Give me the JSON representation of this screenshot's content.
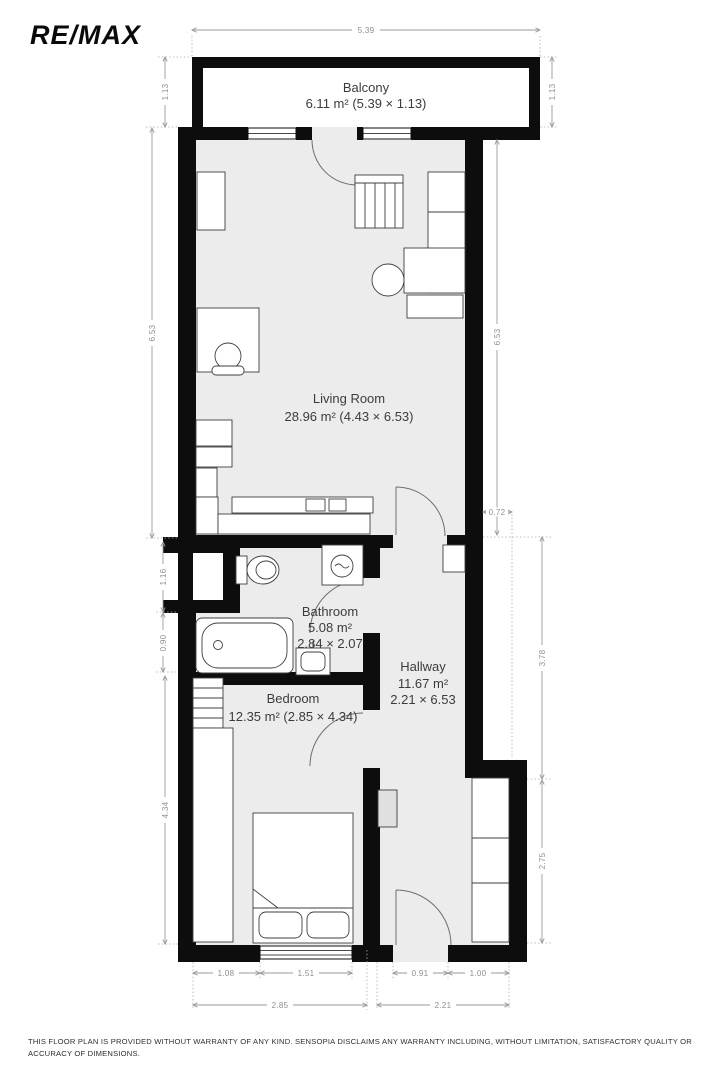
{
  "brand": {
    "logo_text": "RE/MAX"
  },
  "plan": {
    "rooms": {
      "balcony": {
        "name": "Balcony",
        "area": "6.11 m² (5.39 × 1.13)"
      },
      "living_room": {
        "name": "Living Room",
        "area": "28.96 m² (4.43 × 6.53)"
      },
      "bathroom": {
        "name": "Bathroom",
        "area": "5.08 m²",
        "dims": "2.84 × 2.07"
      },
      "hallway": {
        "name": "Hallway",
        "area": "11.67 m²",
        "dims": "2.21 × 6.53"
      },
      "bedroom": {
        "name": "Bedroom",
        "area": "12.35 m² (2.85 × 4.34)"
      }
    },
    "dimensions": {
      "top_total": "5.39",
      "balcony_depth_left": "1.13",
      "balcony_depth_right": "1.13",
      "living_left": "6.53",
      "living_right": "6.53",
      "niche_left": "1.16",
      "bath_left": "0.90",
      "bedroom_left": "4.34",
      "hall_offset": "0.72",
      "hall_upper_right": "3.78",
      "hall_lower_right": "2.75",
      "bottom_seg1": "1.08",
      "bottom_seg2": "1.51",
      "bottom_seg3": "0.91",
      "bottom_seg4": "1.00",
      "bottom_total_left": "2.85",
      "bottom_total_right": "2.21"
    },
    "colors": {
      "wall": "#0d0d0d",
      "floor": "#ececec",
      "dimension_line": "#9a9a9a",
      "label_text": "#3c3c3c"
    }
  },
  "footer": {
    "disclaimer": "THIS FLOOR PLAN IS PROVIDED WITHOUT WARRANTY OF ANY KIND. SENSOPIA DISCLAIMS ANY WARRANTY INCLUDING, WITHOUT LIMITATION, SATISFACTORY QUALITY OR ACCURACY OF DIMENSIONS."
  }
}
